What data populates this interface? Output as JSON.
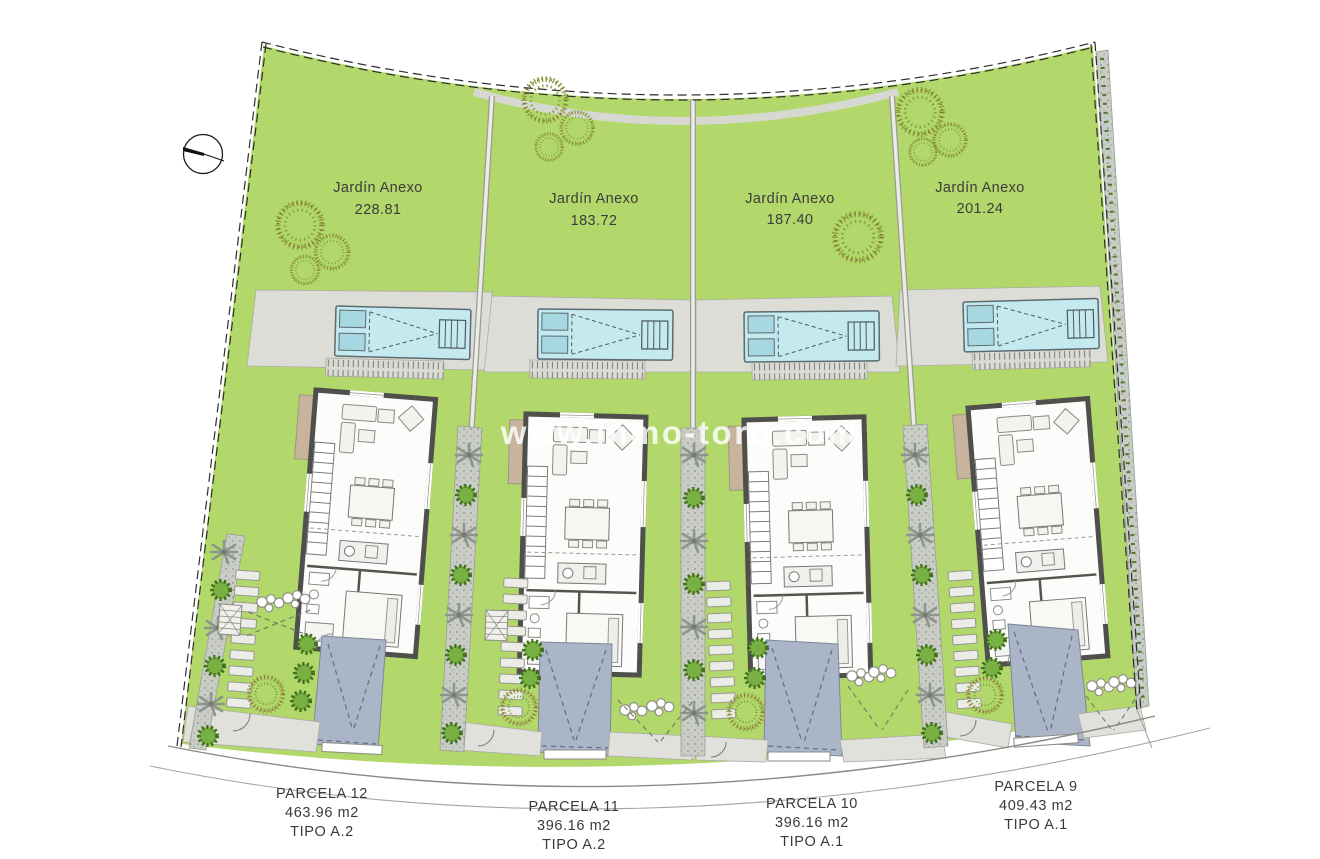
{
  "watermark": {
    "text": "www.inmo-toro.com"
  },
  "compass": {
    "icon": "north-arrow"
  },
  "colors": {
    "garden": "#b2d76a",
    "pool": "#c4e9ef",
    "driveway": "#aab6c8",
    "terrace": "#dcddd6",
    "path_gray": "#c9cdc5",
    "wall": "#4f4f4c"
  },
  "parcels": [
    {
      "name": "PARCELA 12",
      "area": "463.96 m2",
      "tipo": "TIPO A.2",
      "garden": {
        "label": "Jardín Anexo",
        "area": "228.81"
      }
    },
    {
      "name": "PARCELA 11",
      "area": "396.16 m2",
      "tipo": "TIPO A.2",
      "garden": {
        "label": "Jardín Anexo",
        "area": "183.72"
      }
    },
    {
      "name": "PARCELA 10",
      "area": "396.16 m2",
      "tipo": "TIPO A.1",
      "garden": {
        "label": "Jardín Anexo",
        "area": "187.40"
      }
    },
    {
      "name": "PARCELA 9",
      "area": "409.43 m2",
      "tipo": "TIPO A.1",
      "garden": {
        "label": "Jardín Anexo",
        "area": "201.24"
      }
    }
  ]
}
